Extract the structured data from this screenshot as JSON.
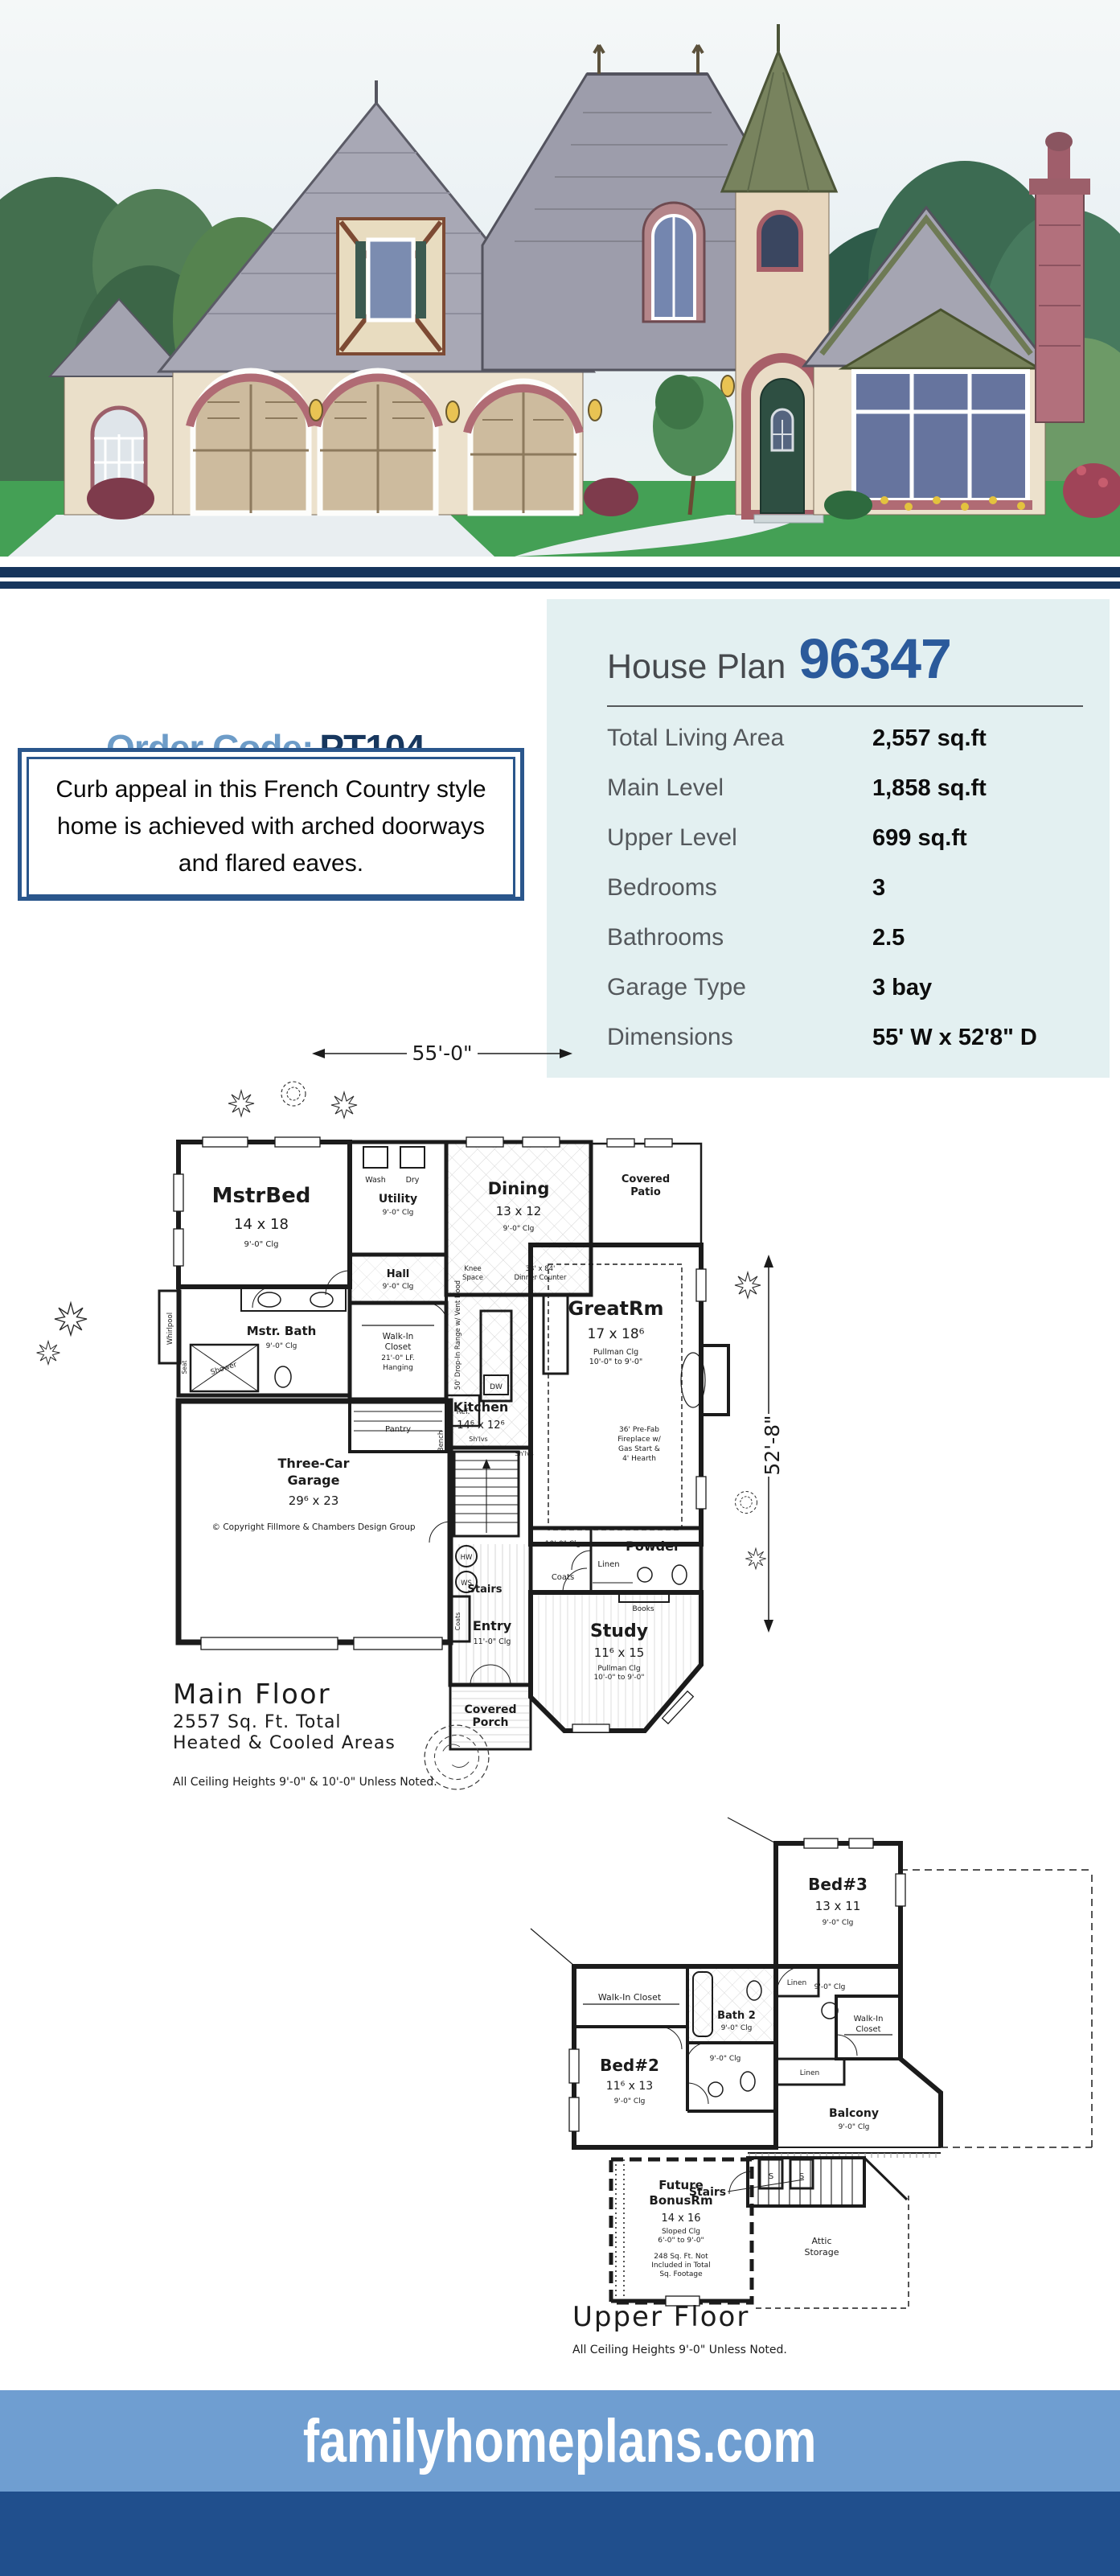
{
  "colors": {
    "accent_navy": "#17375e",
    "steel_blue": "#6d9cc8",
    "plan_blue": "#2b5a9b",
    "panel_bg": "#e3f0f1",
    "footer_light": "#6f9ed1",
    "footer_dark": "#204f8d"
  },
  "order": {
    "label": "Order Code:",
    "code": "PT104"
  },
  "description": "Curb appeal in this French Country style home is achieved with arched doorways and flared eaves.",
  "spec": {
    "title_prefix": "House Plan",
    "plan_number": "96347",
    "rows": [
      {
        "label": "Total Living Area",
        "value": "2,557 sq.ft"
      },
      {
        "label": "Main Level",
        "value": "1,858 sq.ft"
      },
      {
        "label": "Upper Level",
        "value": "699 sq.ft"
      },
      {
        "label": "Bedrooms",
        "value": "3"
      },
      {
        "label": "Bathrooms",
        "value": "2.5"
      },
      {
        "label": "Garage Type",
        "value": "3 bay"
      },
      {
        "label": "Dimensions",
        "value": "55' W x 52'8\" D"
      }
    ]
  },
  "mf": {
    "dim_w": "55'-0\"",
    "dim_d": "52'-8\"",
    "mstrbed1": "MstrBed",
    "mstrbed2": "14 x 18",
    "mstrbed3": "9'-0\" Clg",
    "wash": "Wash",
    "dry": "Dry",
    "utility1": "Utility",
    "utility2": "9'-0\" Clg",
    "hall1": "Hall",
    "hall2": "9'-0\" Clg",
    "dining1": "Dining",
    "dining2": "13 x 12",
    "dining3": "9'-0\" Clg",
    "patio1": "Covered",
    "patio2": "Patio",
    "knee1": "Knee",
    "knee2": "Space",
    "counter1": "33' x 84'",
    "counter2": "Dinner Counter",
    "range": "50' Drop-In Range w/ Vent Hood",
    "greatrm1": "GreatRm",
    "greatrm2": "17 x 18⁶",
    "greatrm3": "Pullman Clg",
    "greatrm4": "10'-0\" to 9'-0\"",
    "fire1": "36' Pre-Fab",
    "fire2": "Fireplace w/",
    "fire3": "Gas Start &",
    "fire4": "4' Hearth",
    "wic1": "Walk-In",
    "wic2": "Closet",
    "wic3": "21'-0\" LF.",
    "wic4": "Hanging",
    "mbath1": "Mstr. Bath",
    "mbath2": "9'-0\" Clg",
    "whirlpool": "Whirlpool",
    "seat": "Seat",
    "shower": "Shower",
    "kitchen1": "Kitchen",
    "kitchen2": "14⁶ x 12⁶",
    "dw": "DW",
    "ref": "Ref.",
    "pantry": "Pantry",
    "bench": "Bench",
    "shlvs": "Sh'lvs",
    "shlvs2": "Sh'lvs",
    "garage1": "Three-Car",
    "garage2": "Garage",
    "garage3": "29⁶ x 23",
    "copyright": "© Copyright Fillmore & Chambers Design Group",
    "hw": "HW",
    "ws": "WS",
    "entry1": "Entry",
    "entry2": "11'-0\" Clg",
    "stairs": "Stairs",
    "coats": "Coats",
    "coats2": "Coats",
    "powder": "Powder",
    "linen": "Linen",
    "books": "Books",
    "clg10": "10'-0\" Clg",
    "study1": "Study",
    "study2": "11⁶ x 15",
    "study3": "Pullman Clg",
    "study4": "10'-0\" to 9'-0\"",
    "porch1": "Covered",
    "porch2": "Porch",
    "caption1": "Main Floor",
    "caption2": "2557 Sq. Ft. Total",
    "caption3": "Heated & Cooled Areas",
    "note": "All Ceiling Heights 9'-0\" & 10'-0\" Unless Noted."
  },
  "uf": {
    "bed3_1": "Bed#3",
    "bed3_2": "13 x 11",
    "bed3_3": "9'-0\" Clg",
    "wic_l": "Walk-In Closet",
    "bath2_1": "Bath 2",
    "bath2_2": "9'-0\" Clg",
    "linen1": "Linen",
    "linen2": "Linen",
    "clg9": "9'-0\" Clg",
    "wic_r1": "Walk-In",
    "wic_r2": "Closet",
    "bed2_1": "Bed#2",
    "bed2_2": "11⁶ x 13",
    "bed2_3": "9'-0\" Clg",
    "wc_clg": "9'-0\" Clg",
    "balcony1": "Balcony",
    "balcony2": "9'-0\" Clg",
    "stairs": "Stairs",
    "s1": "S",
    "s2": "S",
    "bonus1": "Future",
    "bonus2": "BonusRm",
    "bonus3": "14 x 16",
    "bonus4": "Sloped Clg",
    "bonus5": "6'-0\" to 9'-0\"",
    "bonus6": "248 Sq. Ft. Not",
    "bonus7": "Included in Total",
    "bonus8": "Sq. Footage",
    "attic1": "Attic",
    "attic2": "Storage",
    "caption": "Upper Floor",
    "note": "All Ceiling Heights 9'-0\" Unless Noted."
  },
  "footer": {
    "site": "familyhomeplans.com"
  }
}
